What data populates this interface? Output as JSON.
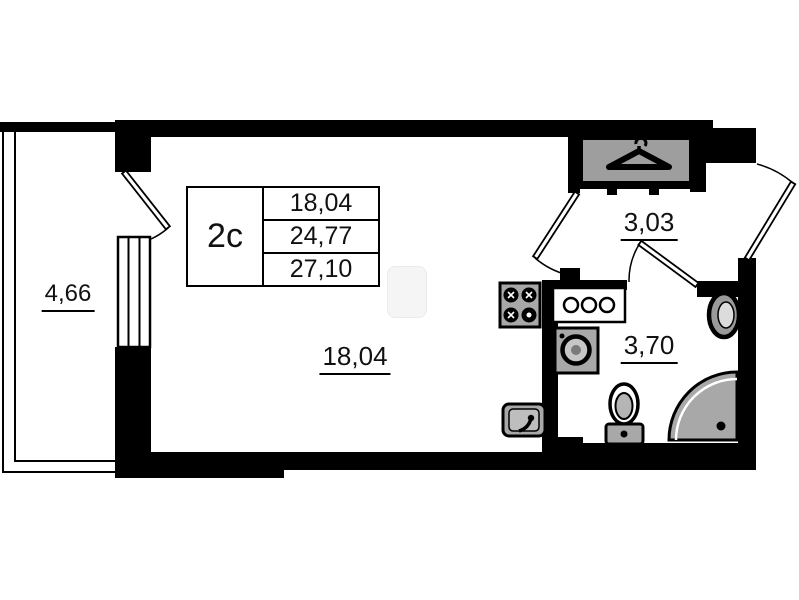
{
  "colors": {
    "wall": "#000000",
    "bg": "#ffffff",
    "fixture": "#a8a8a8"
  },
  "legend": {
    "type_label": "2c",
    "area_values": [
      "18,04",
      "24,77",
      "27,10"
    ]
  },
  "rooms": {
    "living": {
      "area": "18,04"
    },
    "hall": {
      "area": "3,03"
    },
    "bathroom": {
      "area": "3,70"
    },
    "balcony": {
      "area": "4,66"
    }
  }
}
